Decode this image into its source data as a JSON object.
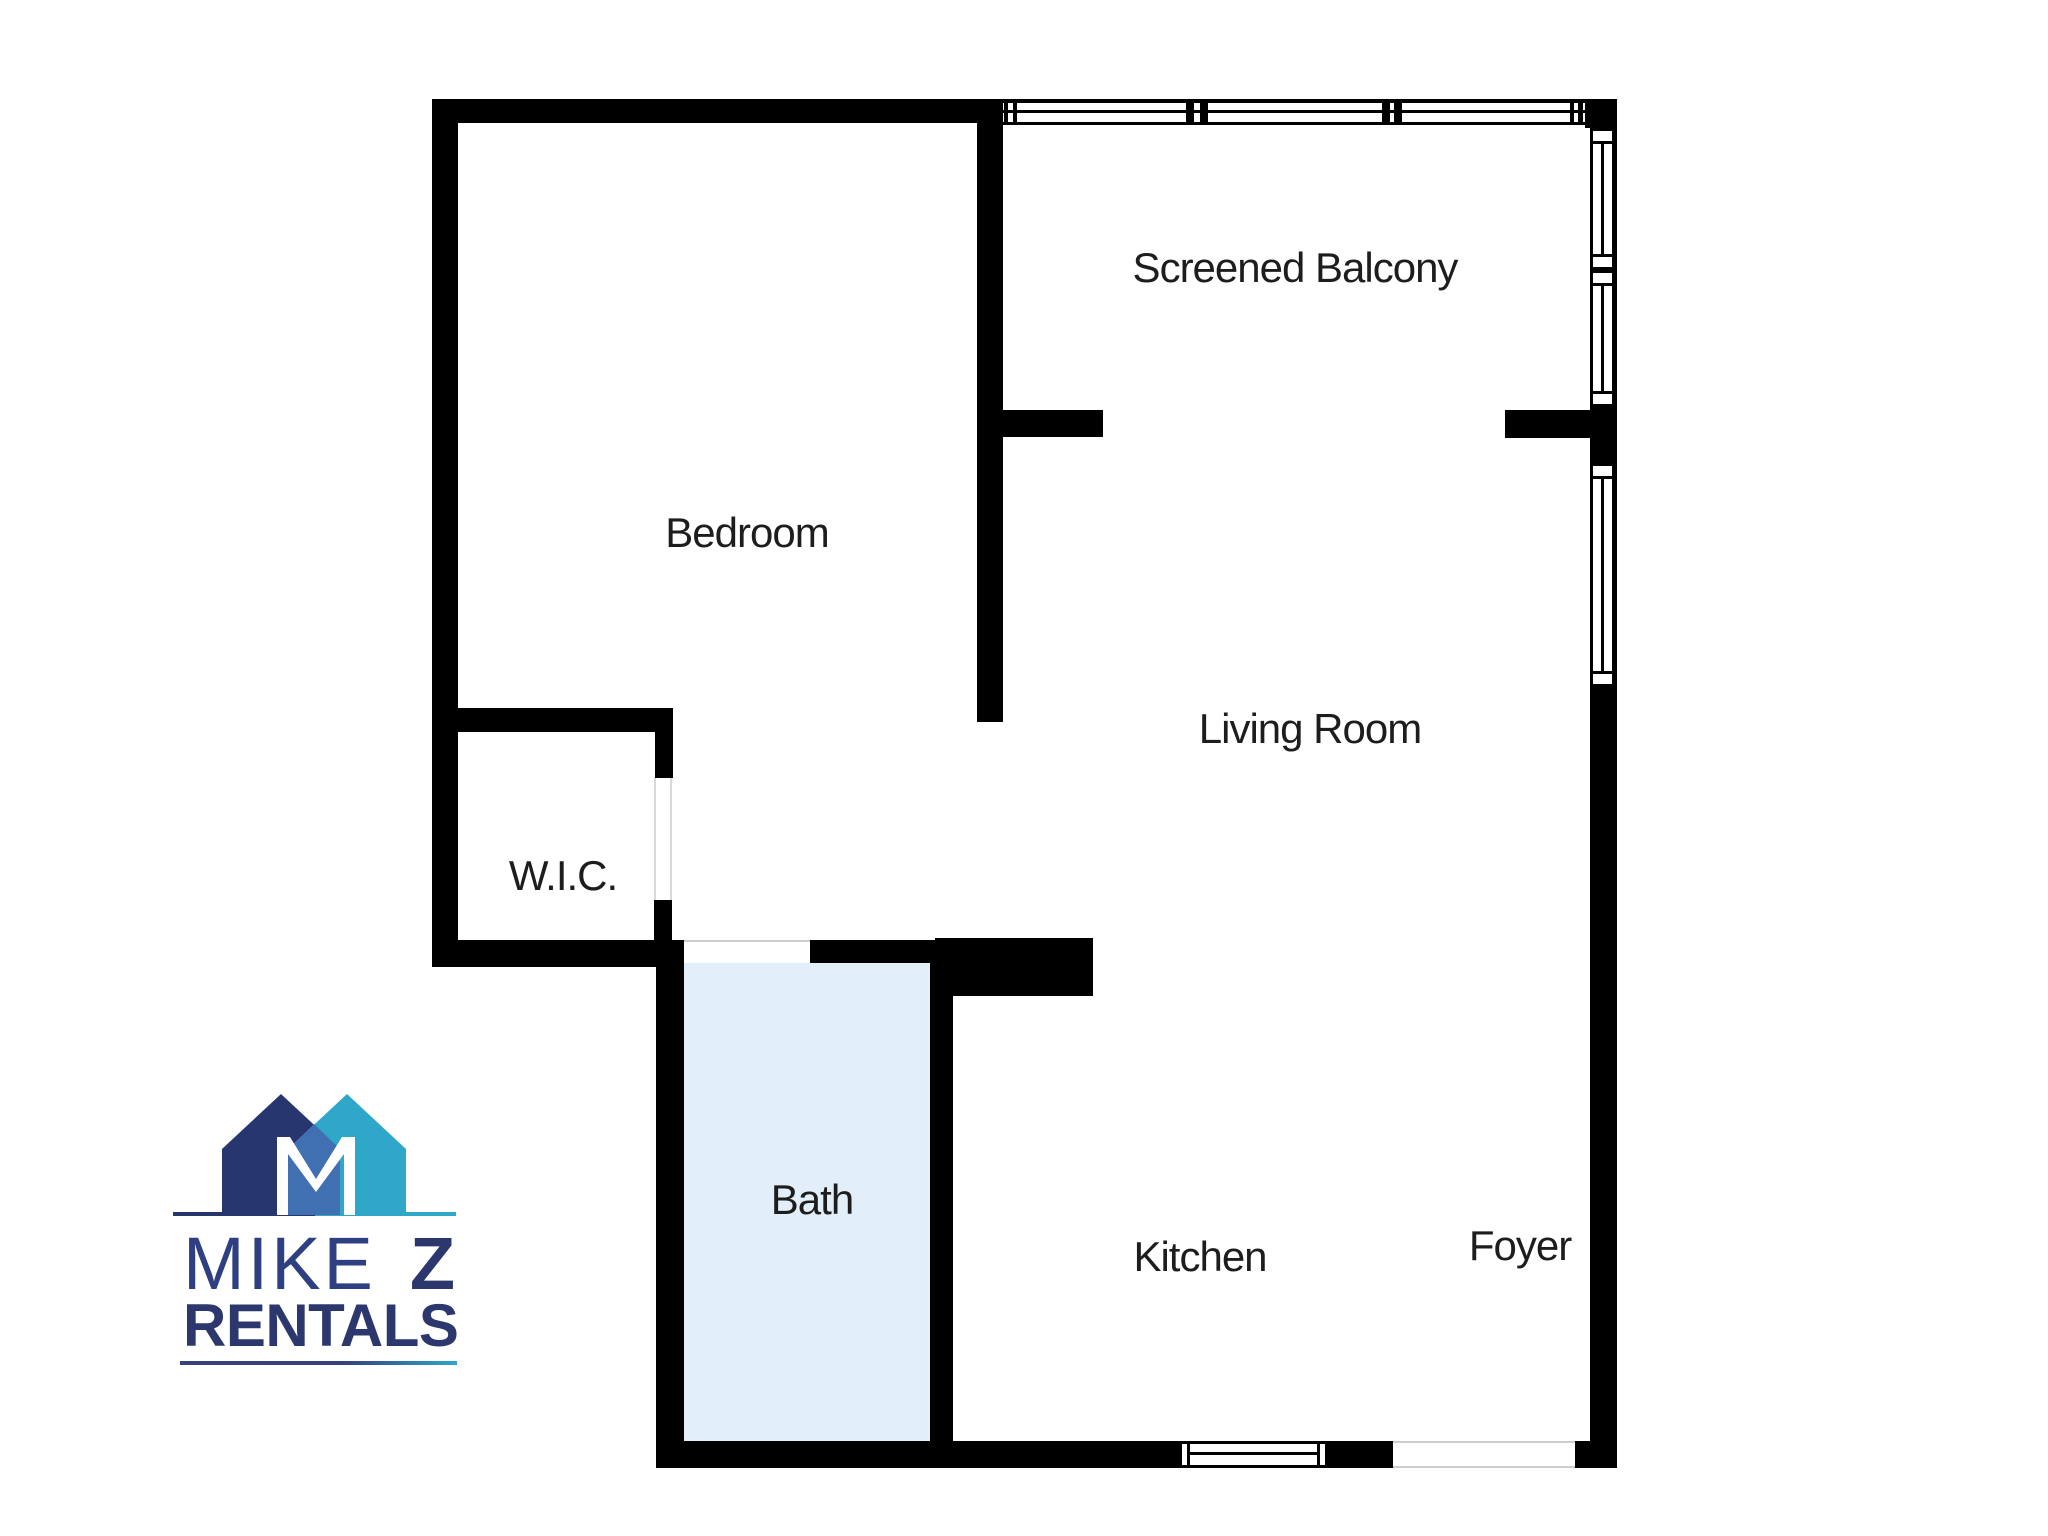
{
  "plan": {
    "rooms": {
      "screened_balcony": "Screened Balcony",
      "bedroom": "Bedroom",
      "living_room": "Living Room",
      "wic": "W.I.C.",
      "bath": "Bath",
      "kitchen": "Kitchen",
      "foyer": "Foyer"
    }
  },
  "logo": {
    "mike": "MIKE",
    "z": "Z",
    "rentals": "RENTALS"
  },
  "colors": {
    "wall": "#000000",
    "bath_floor": "#e2eef8",
    "room_label": "#1d1d1d",
    "logo_navy_house": "#283670",
    "logo_teal_house": "#2fa7c8",
    "logo_overlap": "#4170b2",
    "logo_m_letter": "#ffffff",
    "logo_mike_text": "#2e3f82",
    "logo_dark_text": "#2c386d",
    "logo_rule": "#35427f"
  }
}
